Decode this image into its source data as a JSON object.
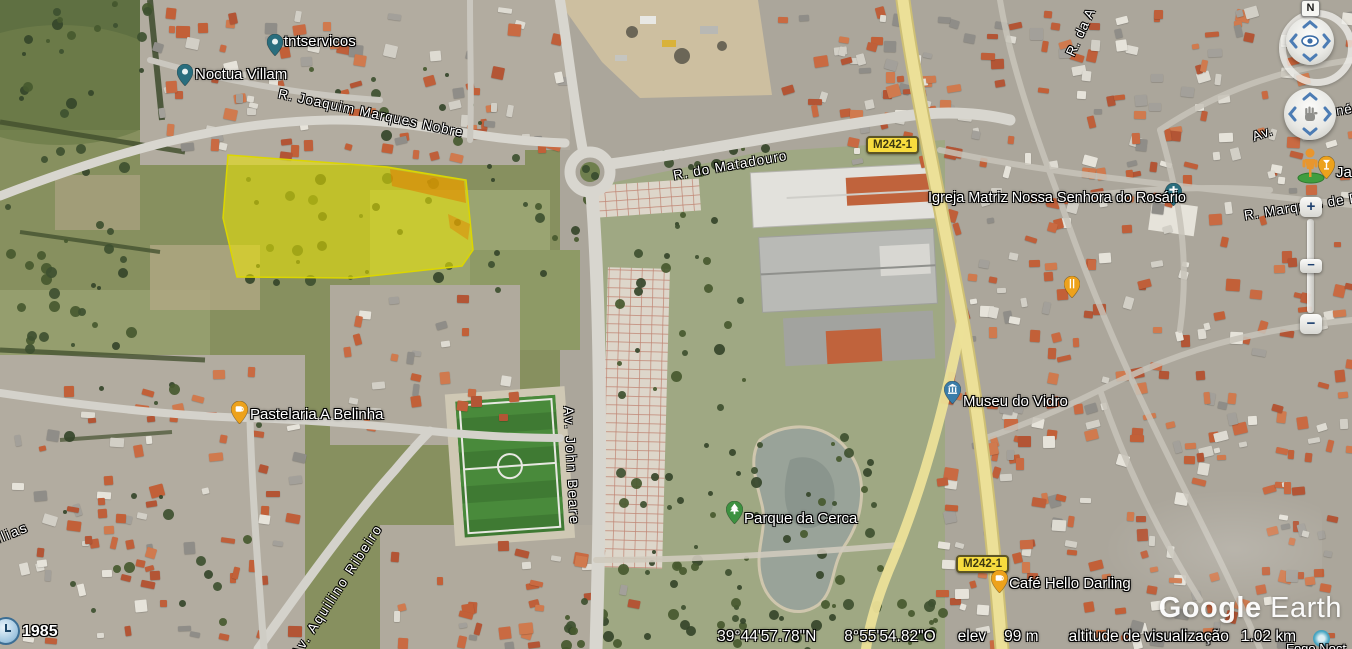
{
  "status_bar": {
    "latitude": "39°44'57.78\"N",
    "longitude": "8°55'54.82\"O",
    "elev_label": "elev",
    "elevation": "99 m",
    "view_alt_label": "altitude de visualização",
    "view_altitude": "1.02 km"
  },
  "imagery_year": "1985",
  "logo": {
    "google": "Google",
    "earth": "Earth"
  },
  "controls": {
    "north": "N",
    "zoom_in": "+",
    "zoom_out": "−",
    "handle": "−"
  },
  "shields": [
    {
      "label": "M242-1"
    },
    {
      "label": "M242-1"
    }
  ],
  "pois": [
    {
      "label": "tntservicos",
      "icon": "place-pin",
      "color": "#2a6e7e"
    },
    {
      "label": "Noctua Villam",
      "icon": "place-pin",
      "color": "#2a6e7e"
    },
    {
      "label": "Igreja Matriz Nossa Senhora do Rosário",
      "icon": "church-pin",
      "color": "#2a6e7e"
    },
    {
      "label": "Museu do Vidro",
      "icon": "museum-pin",
      "color": "#3a7ca8"
    },
    {
      "label": "Parque da Cerca",
      "icon": "park-pin",
      "color": "#3d9140"
    },
    {
      "label": "Pastelaria A Belinha",
      "icon": "cafe-pin",
      "color": "#eda21c"
    },
    {
      "label": "Café Hello Darling",
      "icon": "cafe-pin",
      "color": "#eda21c"
    },
    {
      "label": "Ja",
      "icon": "bar-pin",
      "color": "#eda21c"
    },
    {
      "label": "",
      "icon": "restaurant-pin",
      "color": "#eda21c"
    },
    {
      "label": "Fogo Noct",
      "icon": "photo-icon",
      "color": "#45a8c6"
    }
  ],
  "street_labels": [
    "R. Joaquim Marques Nobre",
    "R. do Matadouro",
    "Av. John Beare",
    "Av. Aquilino Ribeiro",
    "R. Marquês de P",
    "R. da A",
    "Av.",
    "né",
    "Tílias"
  ],
  "parcel": {
    "fill": "#eee800",
    "accent": "#e07c00"
  }
}
